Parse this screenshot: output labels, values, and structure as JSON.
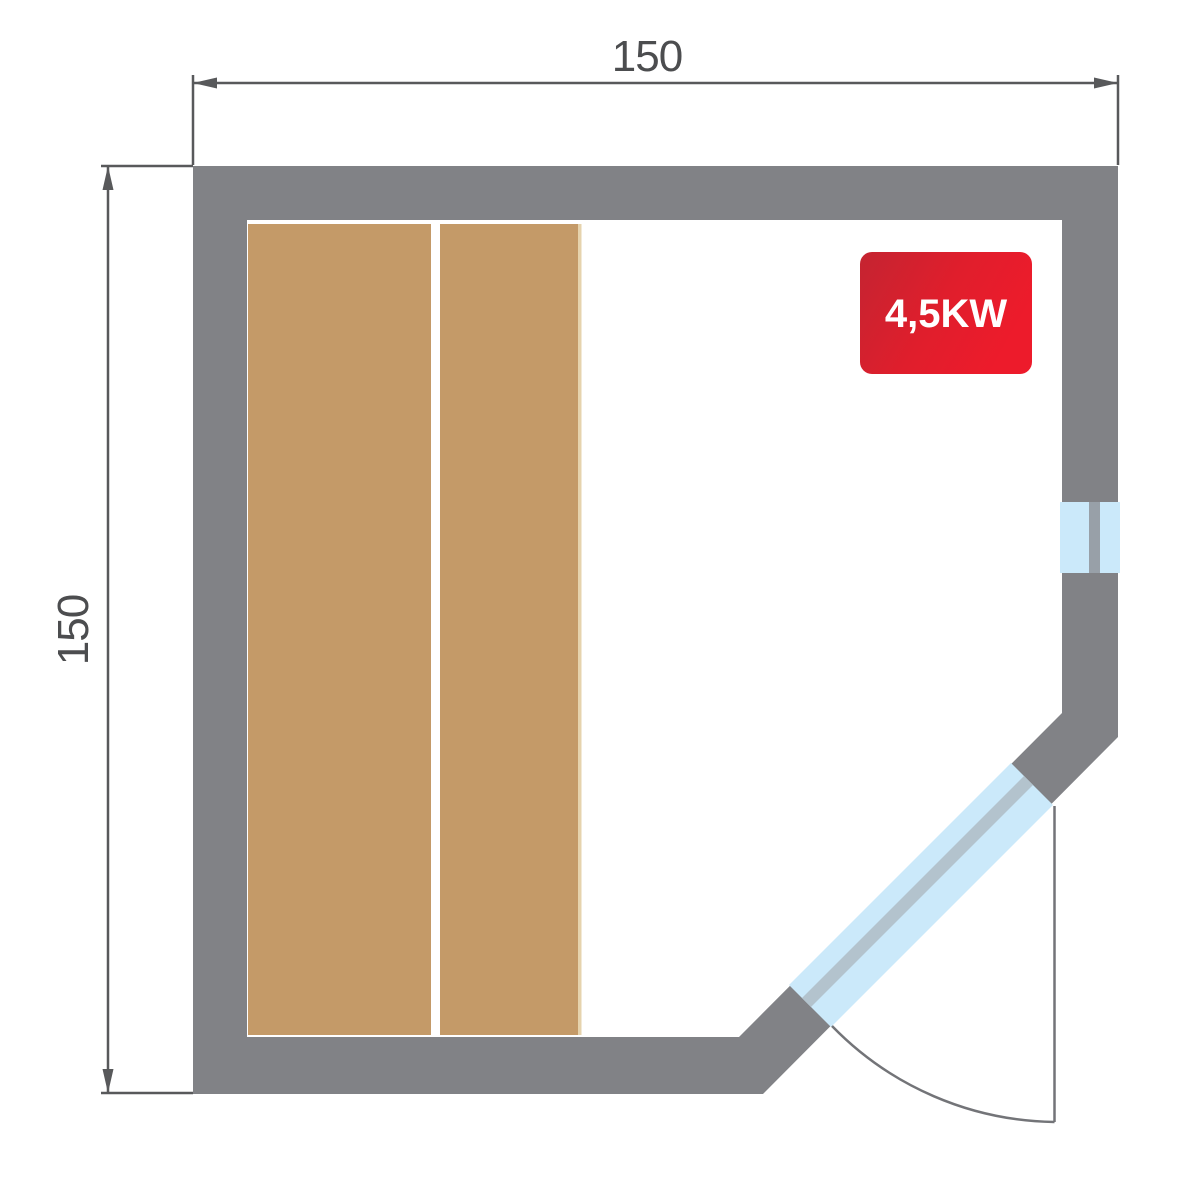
{
  "title": "Sauna floor plan",
  "dimensions": {
    "top": {
      "label": "150"
    },
    "left": {
      "label": "150"
    }
  },
  "heater": {
    "label": "4,5KW"
  },
  "colors": {
    "wall": "#818286",
    "bench": "#c49a68",
    "bench_edge_highlight": "#e6d3ad",
    "glass": "#cbe9fa",
    "glass_frame": "#b3c3cd",
    "window_divider": "#98a0a8",
    "dimension": "#58595b",
    "dimension_text": "#4c4d4f",
    "door_swing": "#737478",
    "heater_gradient_start": "#c42431",
    "heater_gradient_mid": "#e01e2c",
    "heater_gradient_end": "#ed1b2b",
    "heater_text": "#ffffff",
    "background": "#ffffff"
  }
}
